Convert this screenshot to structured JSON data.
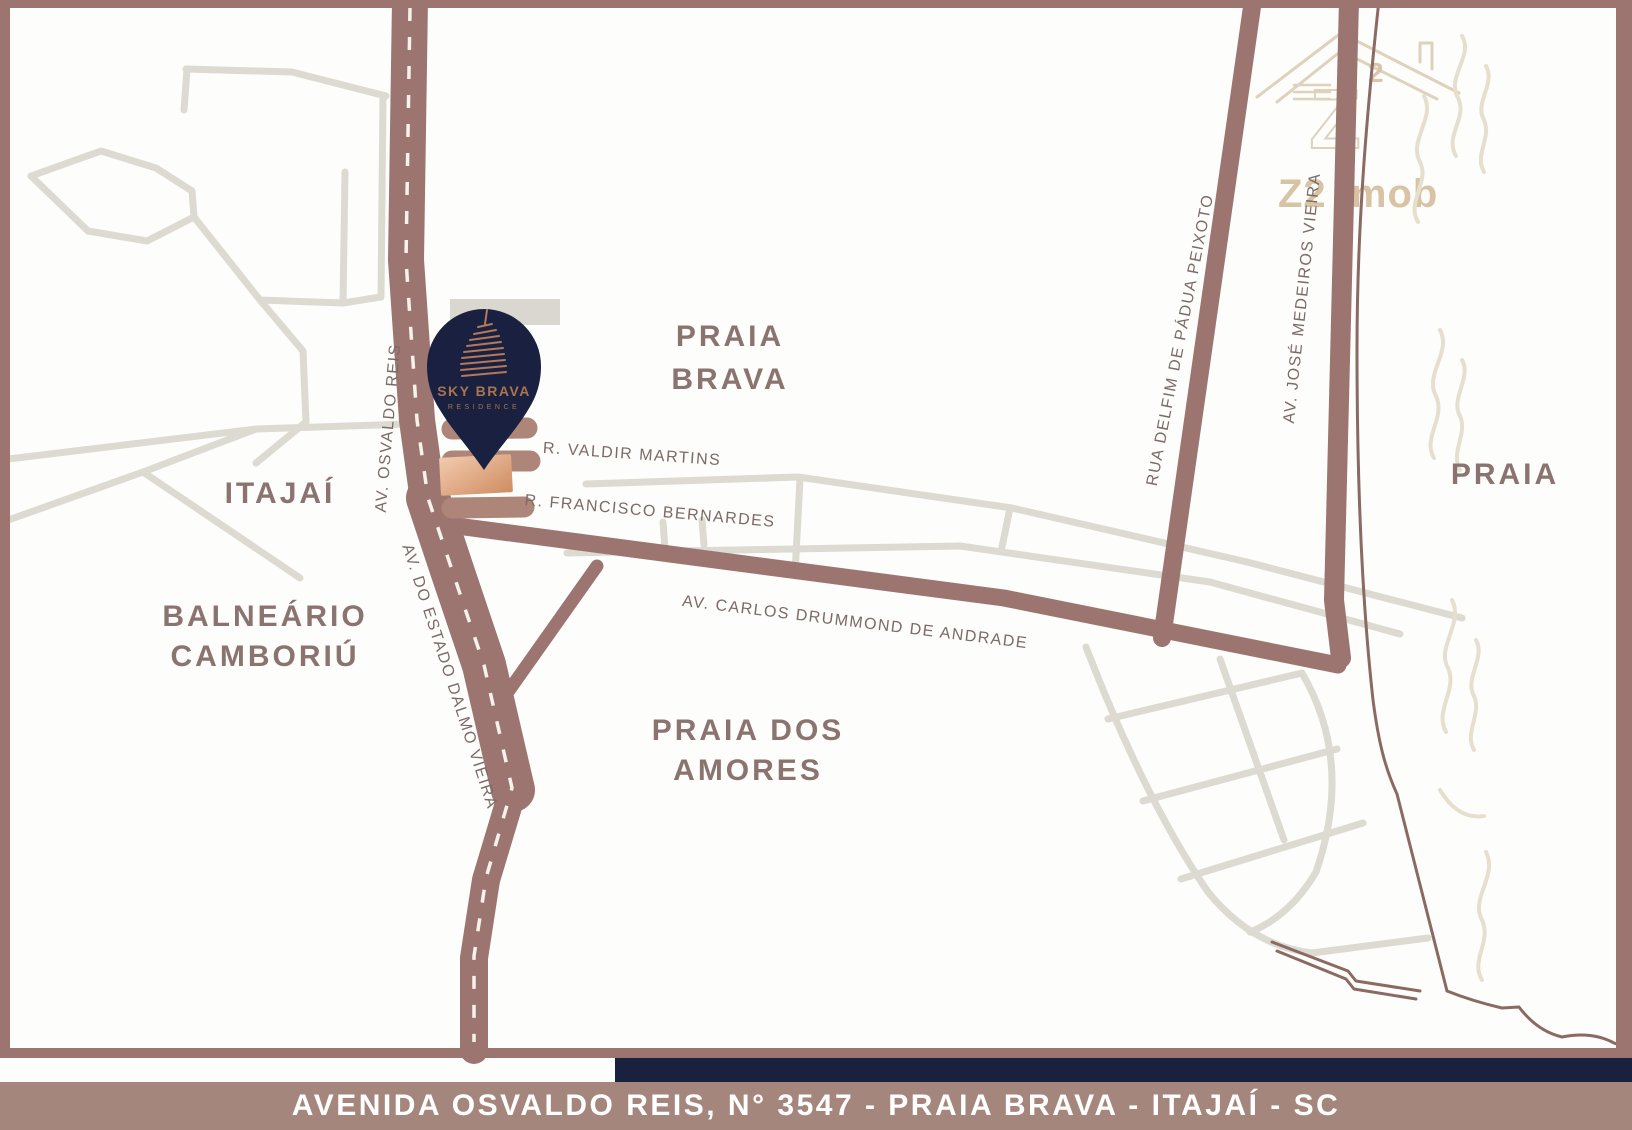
{
  "banner": {
    "text": "AVENIDA OSVALDO REIS, N° 3547 - PRAIA BRAVA - ITAJAÍ - SC"
  },
  "pin": {
    "title": "SKY BRAVA",
    "tagline": "RESIDENCE"
  },
  "watermark": {
    "mark": "Z",
    "mark_sup": "2",
    "wordmark": "Z2 Imob"
  },
  "areas": {
    "praia_brava": {
      "line1": "PRAIA",
      "line2": "BRAVA"
    },
    "itajai": {
      "line1": "ITAJAÍ"
    },
    "balneario_camboriu": {
      "line1": "BALNEÁRIO",
      "line2": "CAMBORIÚ"
    },
    "praia_dos_amores": {
      "line1": "PRAIA DOS",
      "line2": "AMORES"
    },
    "praia": {
      "line1": "PRAIA"
    }
  },
  "streets": {
    "osvaldo_reis": "AV. OSVALDO REIS",
    "valdir_martins": "R. VALDIR MARTINS",
    "francisco_bernardes": "R. FRANCISCO BERNARDES",
    "carlos_drummond": "AV. CARLOS DRUMMOND DE ANDRADE",
    "dalmo_vieira": "AV. DO ESTADO DALMO VIEIRA",
    "delfim_peixoto": "RUA DELFIM DE PÁDUA PEIXOTO",
    "jose_medeiros": "AV. JOSÉ MEDEIROS VIEIRA"
  },
  "colors": {
    "road": "#9c7571",
    "road_light": "#ae8679",
    "gray_street": "#dcdad1",
    "navy_pin": "#1a2140",
    "navy_strip": "#19213f",
    "banner_bg": "#a5867c",
    "banner_text": "#ffffff",
    "area_label": "#8b7370",
    "street_label": "#7c6a66",
    "watermark_tan": "#ded2bc",
    "copper": "#b4795a",
    "lot_light": "#f2cbae",
    "lot_dark": "#cf8c61",
    "coastline": "#8a6a62",
    "background": "#fdfdfc"
  }
}
